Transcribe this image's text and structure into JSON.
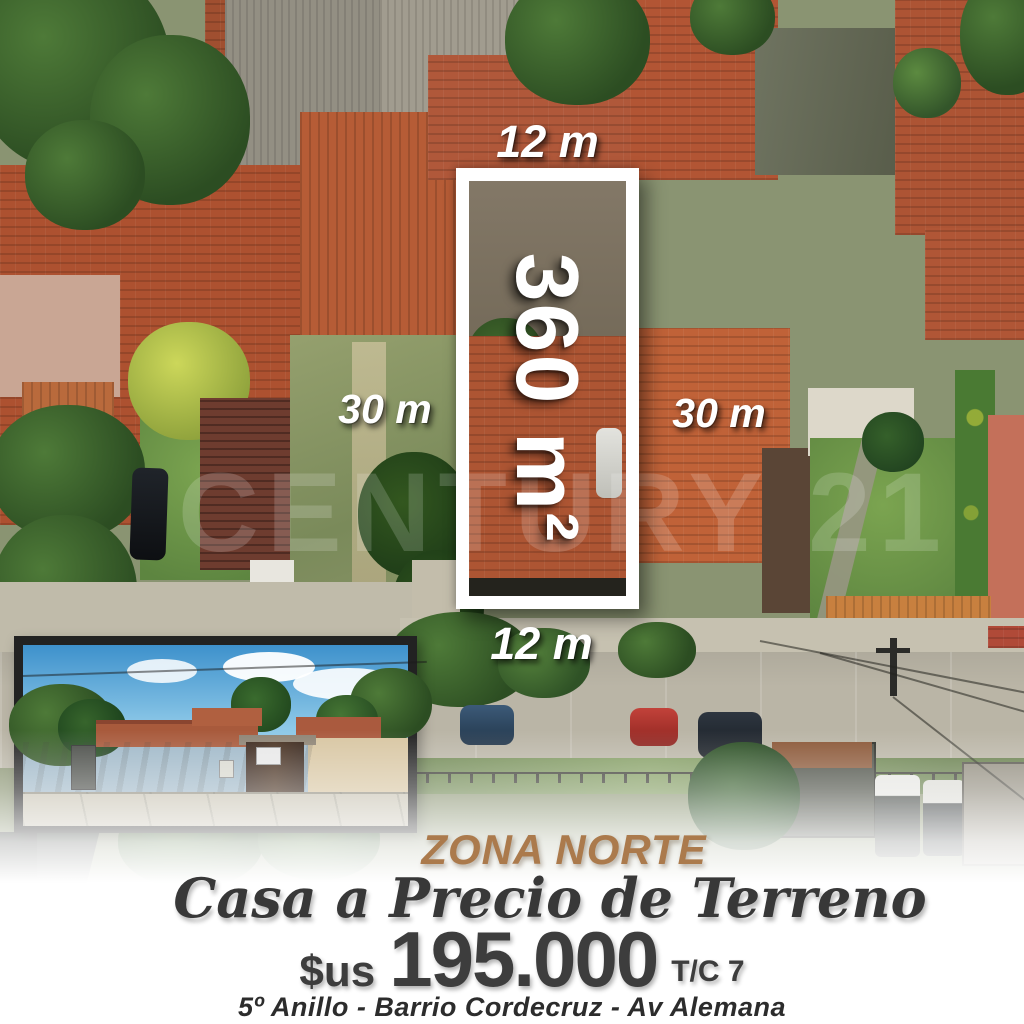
{
  "ad": {
    "zone": "ZONA NORTE",
    "tagline": "Casa a Precio de Terreno",
    "price": {
      "currency": "$us",
      "amount": "195.000",
      "suffix": "T/C 7"
    },
    "location": "5º Anillo - Barrio Cordecruz - Av Alemana"
  },
  "plot": {
    "front_top": "12 m",
    "front_bottom": "12 m",
    "side_left": "30 m",
    "side_right": "30 m",
    "area": "360 m²"
  },
  "watermark": "CENTURY 21",
  "colors": {
    "zone_text": "#ab7a4c",
    "body_text": "#3a3a3a",
    "dimension_text": "#ffffff",
    "accent_terracotta": "#b45a36"
  }
}
